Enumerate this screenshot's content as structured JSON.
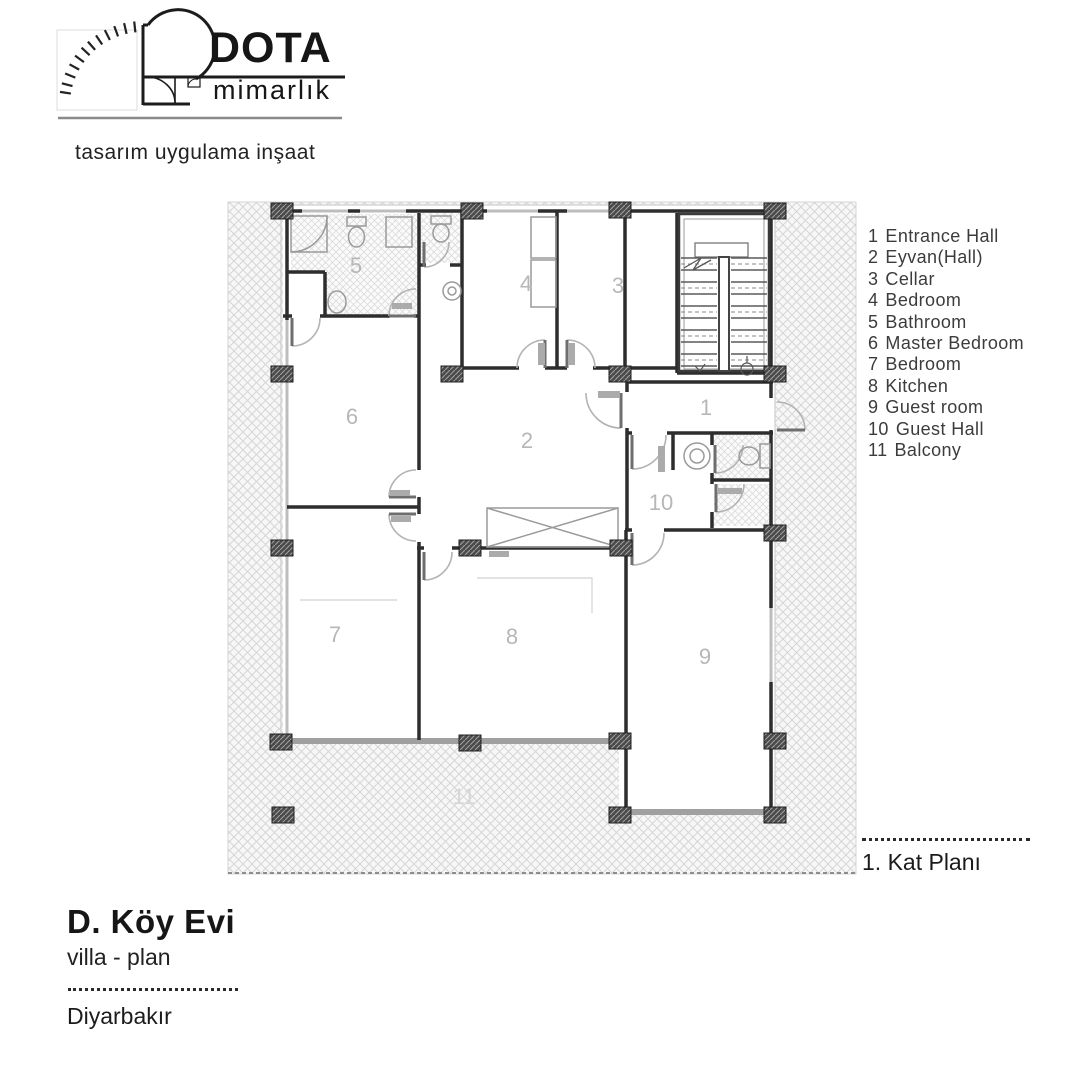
{
  "brand": {
    "name": "DOTA",
    "subtitle": "mimarlık",
    "tagline": "tasarım uygulama inşaat"
  },
  "legend": {
    "items": [
      {
        "num": "1",
        "label": "Entrance Hall"
      },
      {
        "num": "2",
        "label": "Eyvan(Hall)"
      },
      {
        "num": "3",
        "label": "Cellar"
      },
      {
        "num": "4",
        "label": "Bedroom"
      },
      {
        "num": "5",
        "label": "Bathroom"
      },
      {
        "num": "6",
        "label": "Master Bedroom"
      },
      {
        "num": "7",
        "label": "Bedroom"
      },
      {
        "num": "8",
        "label": "Kitchen"
      },
      {
        "num": "9",
        "label": "Guest room"
      },
      {
        "num": "10",
        "label": "Guest Hall"
      },
      {
        "num": "11",
        "label": "Balcony"
      }
    ]
  },
  "plan": {
    "room_labels": [
      {
        "num": "1"
      },
      {
        "num": "2"
      },
      {
        "num": "3"
      },
      {
        "num": "4"
      },
      {
        "num": "5"
      },
      {
        "num": "6"
      },
      {
        "num": "7"
      },
      {
        "num": "8"
      },
      {
        "num": "9"
      },
      {
        "num": "10"
      },
      {
        "num": "11"
      }
    ]
  },
  "titleblock": {
    "project": "D. Köy Evi",
    "subtitle": "villa - plan",
    "location": "Diyarbakır"
  },
  "plate": {
    "plan_label": "1. Kat Planı"
  },
  "colors": {
    "wall": "#2d2d2d",
    "window_wall": "#bdbdbd",
    "hatch_line": "#d6d6d6",
    "room_label": "#b7b7b7",
    "terrace_edge": "#a0a0a0"
  }
}
